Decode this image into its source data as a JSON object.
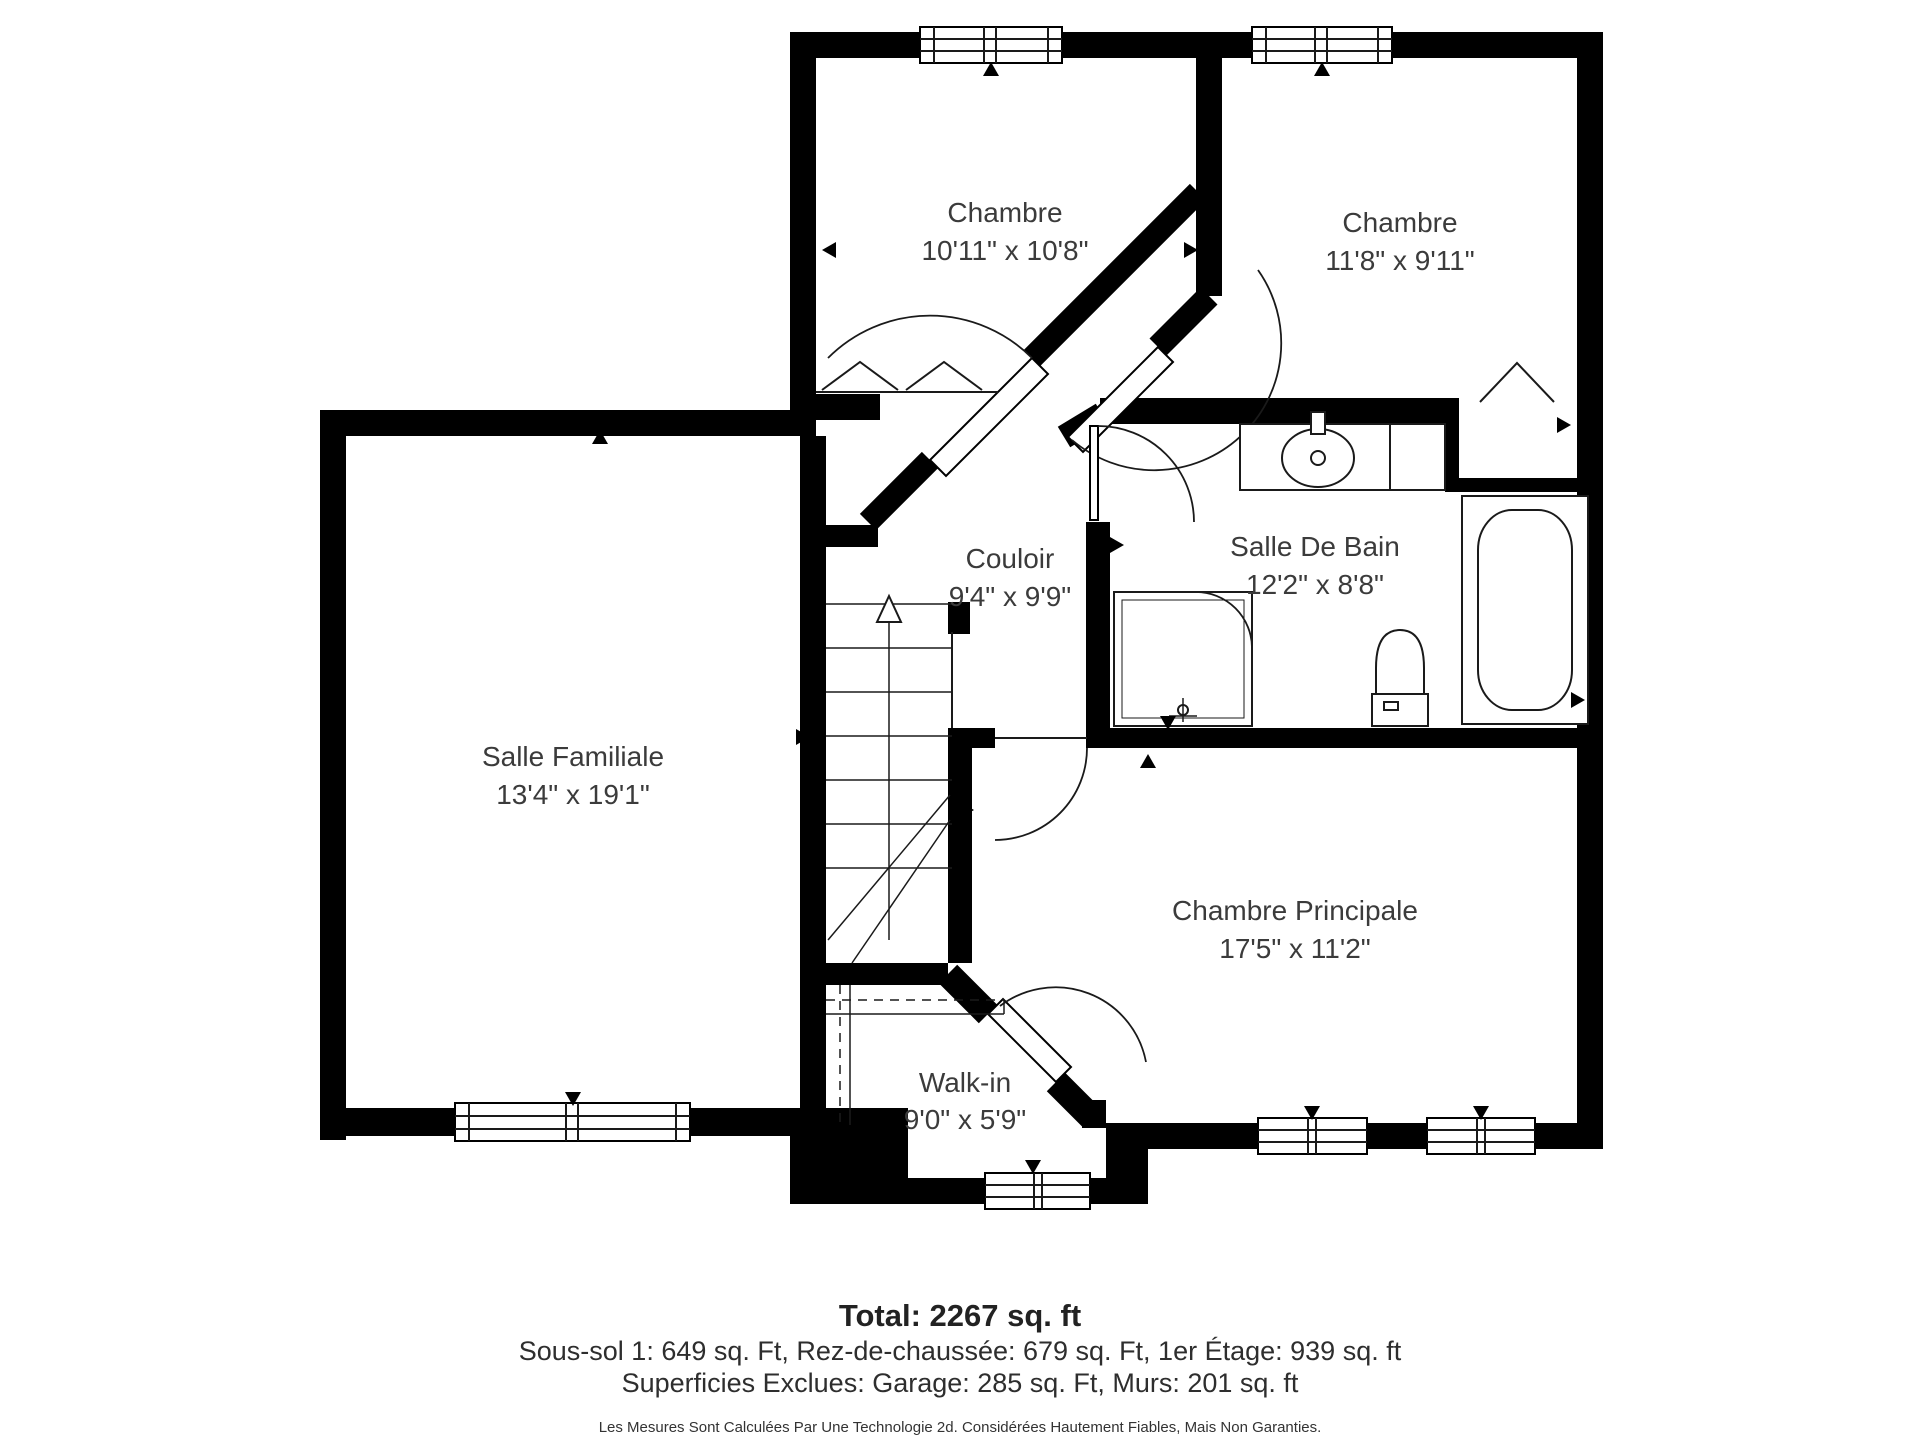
{
  "rooms": [
    {
      "name": "Chambre",
      "dimensions": "10'11\" x 10'8\""
    },
    {
      "name": "Chambre",
      "dimensions": "11'8\" x 9'11\""
    },
    {
      "name": "Couloir",
      "dimensions": "9'4\" x 9'9\""
    },
    {
      "name": "Salle De Bain",
      "dimensions": "12'2\" x 8'8\""
    },
    {
      "name": "Salle Familiale",
      "dimensions": "13'4\" x 19'1\""
    },
    {
      "name": "Chambre Principale",
      "dimensions": "17'5\" x 11'2\""
    },
    {
      "name": "Walk-in",
      "dimensions": "9'0\" x 5'9\""
    }
  ],
  "footer": {
    "total": "Total: 2267 sq. ft",
    "areas": "Sous-sol 1: 649 sq. Ft, Rez-de-chaussée: 679 sq. Ft, 1er Étage: 939 sq. ft",
    "excluded": "Superficies Exclues: Garage: 285 sq. Ft, Murs: 201 sq. ft",
    "disclaimer": "Les Mesures Sont Calculées Par Une Technologie 2d. Considérées Hautement Fiables, Mais Non Garanties."
  },
  "colors": {
    "wall": "#000000",
    "text": "#3b3b3b",
    "background": "#ffffff"
  }
}
